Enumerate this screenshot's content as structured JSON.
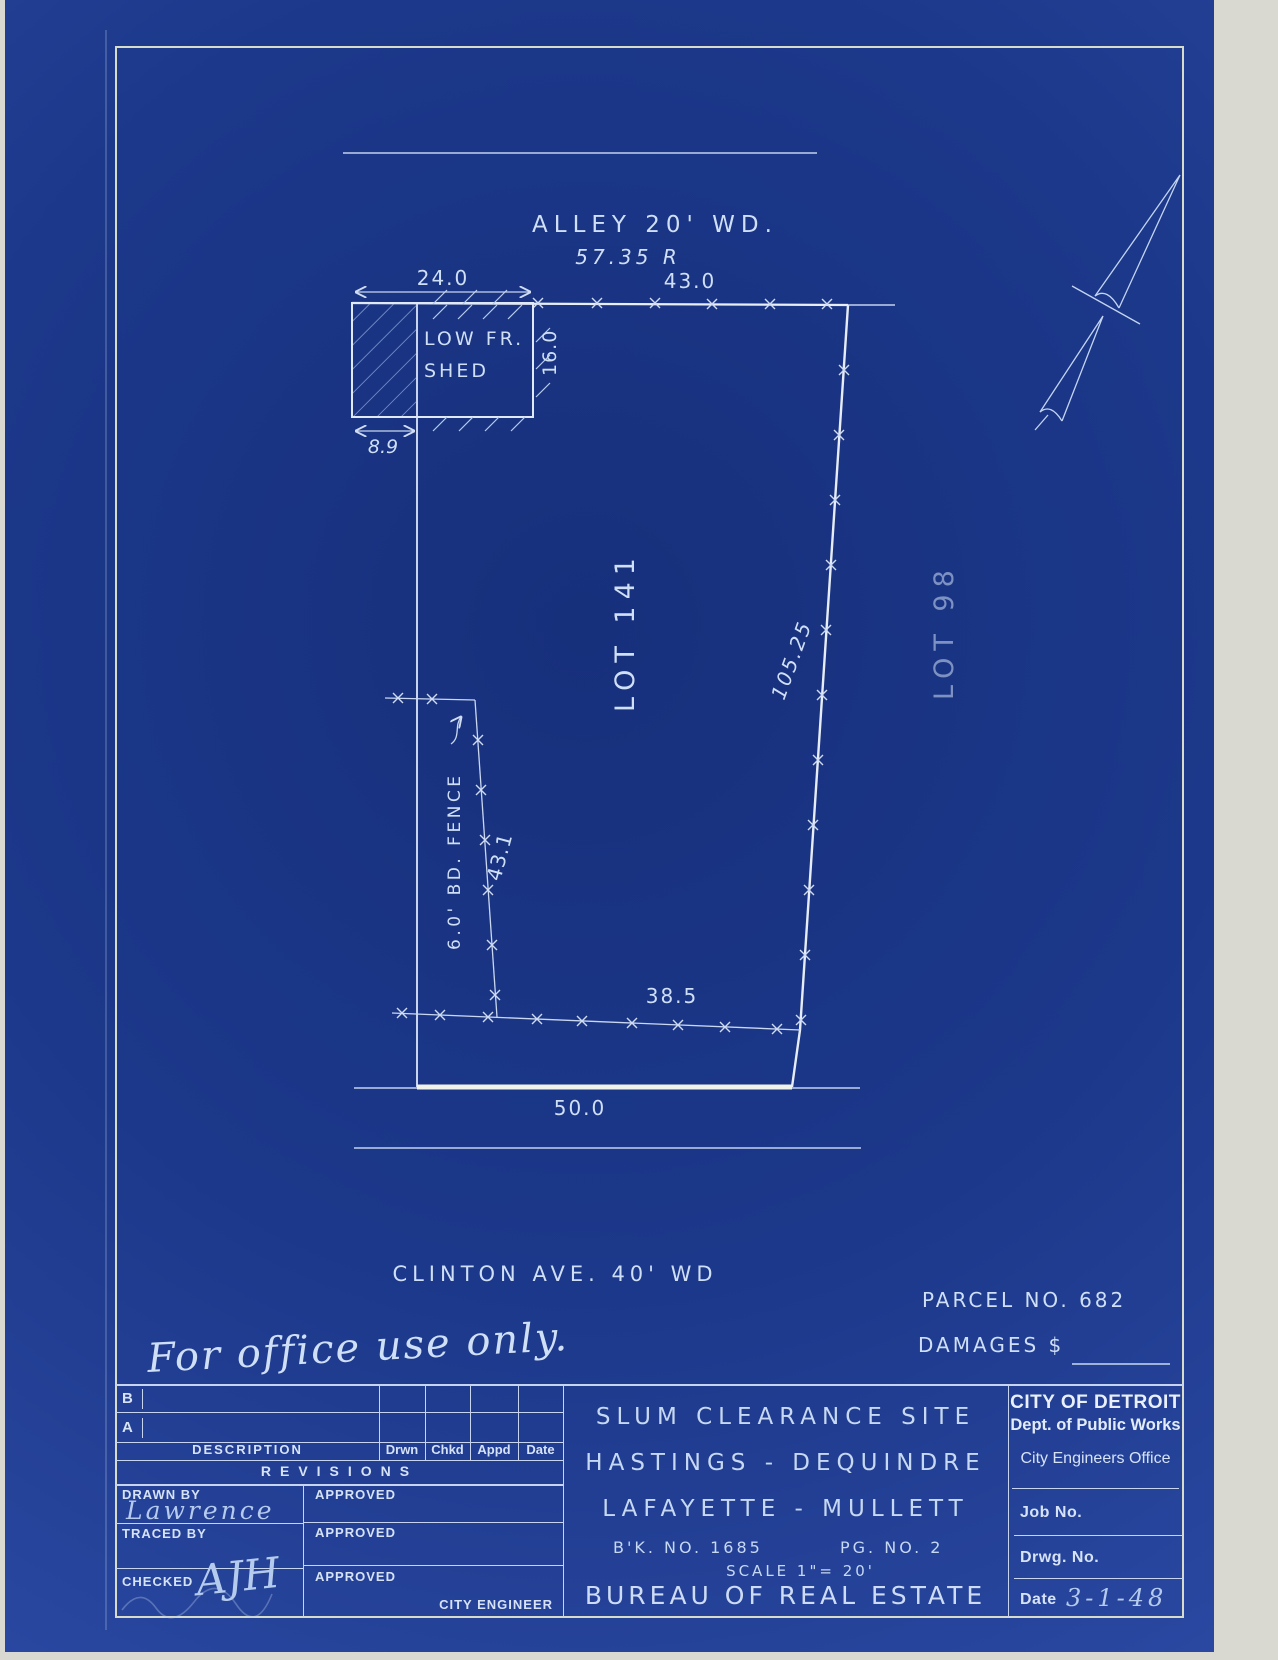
{
  "colors": {
    "paper_blue": "#1c388a",
    "ink": "#cfdff6",
    "bright_line": "#eff3ea"
  },
  "drawing": {
    "alley_label": "ALLEY 20' WD.",
    "alley_dim": "57.35 R",
    "dim_24": "24.0",
    "dim_43": "43.0",
    "shed_line1": "LOW FR.",
    "shed_line2": "SHED",
    "dim_16": "16.0",
    "dim_8_9": "8.9",
    "lot_main": "LOT 141",
    "dim_105": "105.25",
    "lot_east": "LOT 98",
    "fence_label": "6.0' BD. FENCE",
    "dim_43_1": "43.1",
    "dim_38_5": "38.5",
    "dim_50": "50.0",
    "street_label": "CLINTON AVE.  40' WD",
    "parcel_label": "PARCEL NO. 682",
    "damages_label": "DAMAGES $",
    "office_note": "For office use only."
  },
  "titleblock": {
    "revisions": {
      "row_b": "B",
      "row_a": "A",
      "col_description": "DESCRIPTION",
      "col_drwn": "Drwn",
      "col_chkd": "Chkd",
      "col_appd": "Appd",
      "col_date": "Date",
      "title": "REVISIONS"
    },
    "signoff": {
      "drawn_by": "DRAWN BY",
      "drawn_by_value": "Lawrence",
      "traced_by": "TRACED BY",
      "checked": "CHECKED",
      "checked_value": "AJH",
      "approved1": "APPROVED",
      "approved2": "APPROVED",
      "approved3": "APPROVED",
      "city_engineer": "CITY ENGINEER"
    },
    "title": {
      "line1": "SLUM CLEARANCE SITE",
      "line2": "HASTINGS - DEQUINDRE",
      "line3": "LAFAYETTE - MULLETT",
      "book": "B'K. NO. 1685",
      "page": "PG. NO. 2",
      "scale": "SCALE 1\"= 20'",
      "bureau": "BUREAU OF REAL ESTATE"
    },
    "agency": {
      "line1": "CITY OF DETROIT",
      "line2": "Dept. of Public Works",
      "line3": "City Engineers Office",
      "job_no": "Job No.",
      "drwg_no": "Drwg. No.",
      "date_label": "Date",
      "date_value": "3-1-48"
    }
  }
}
